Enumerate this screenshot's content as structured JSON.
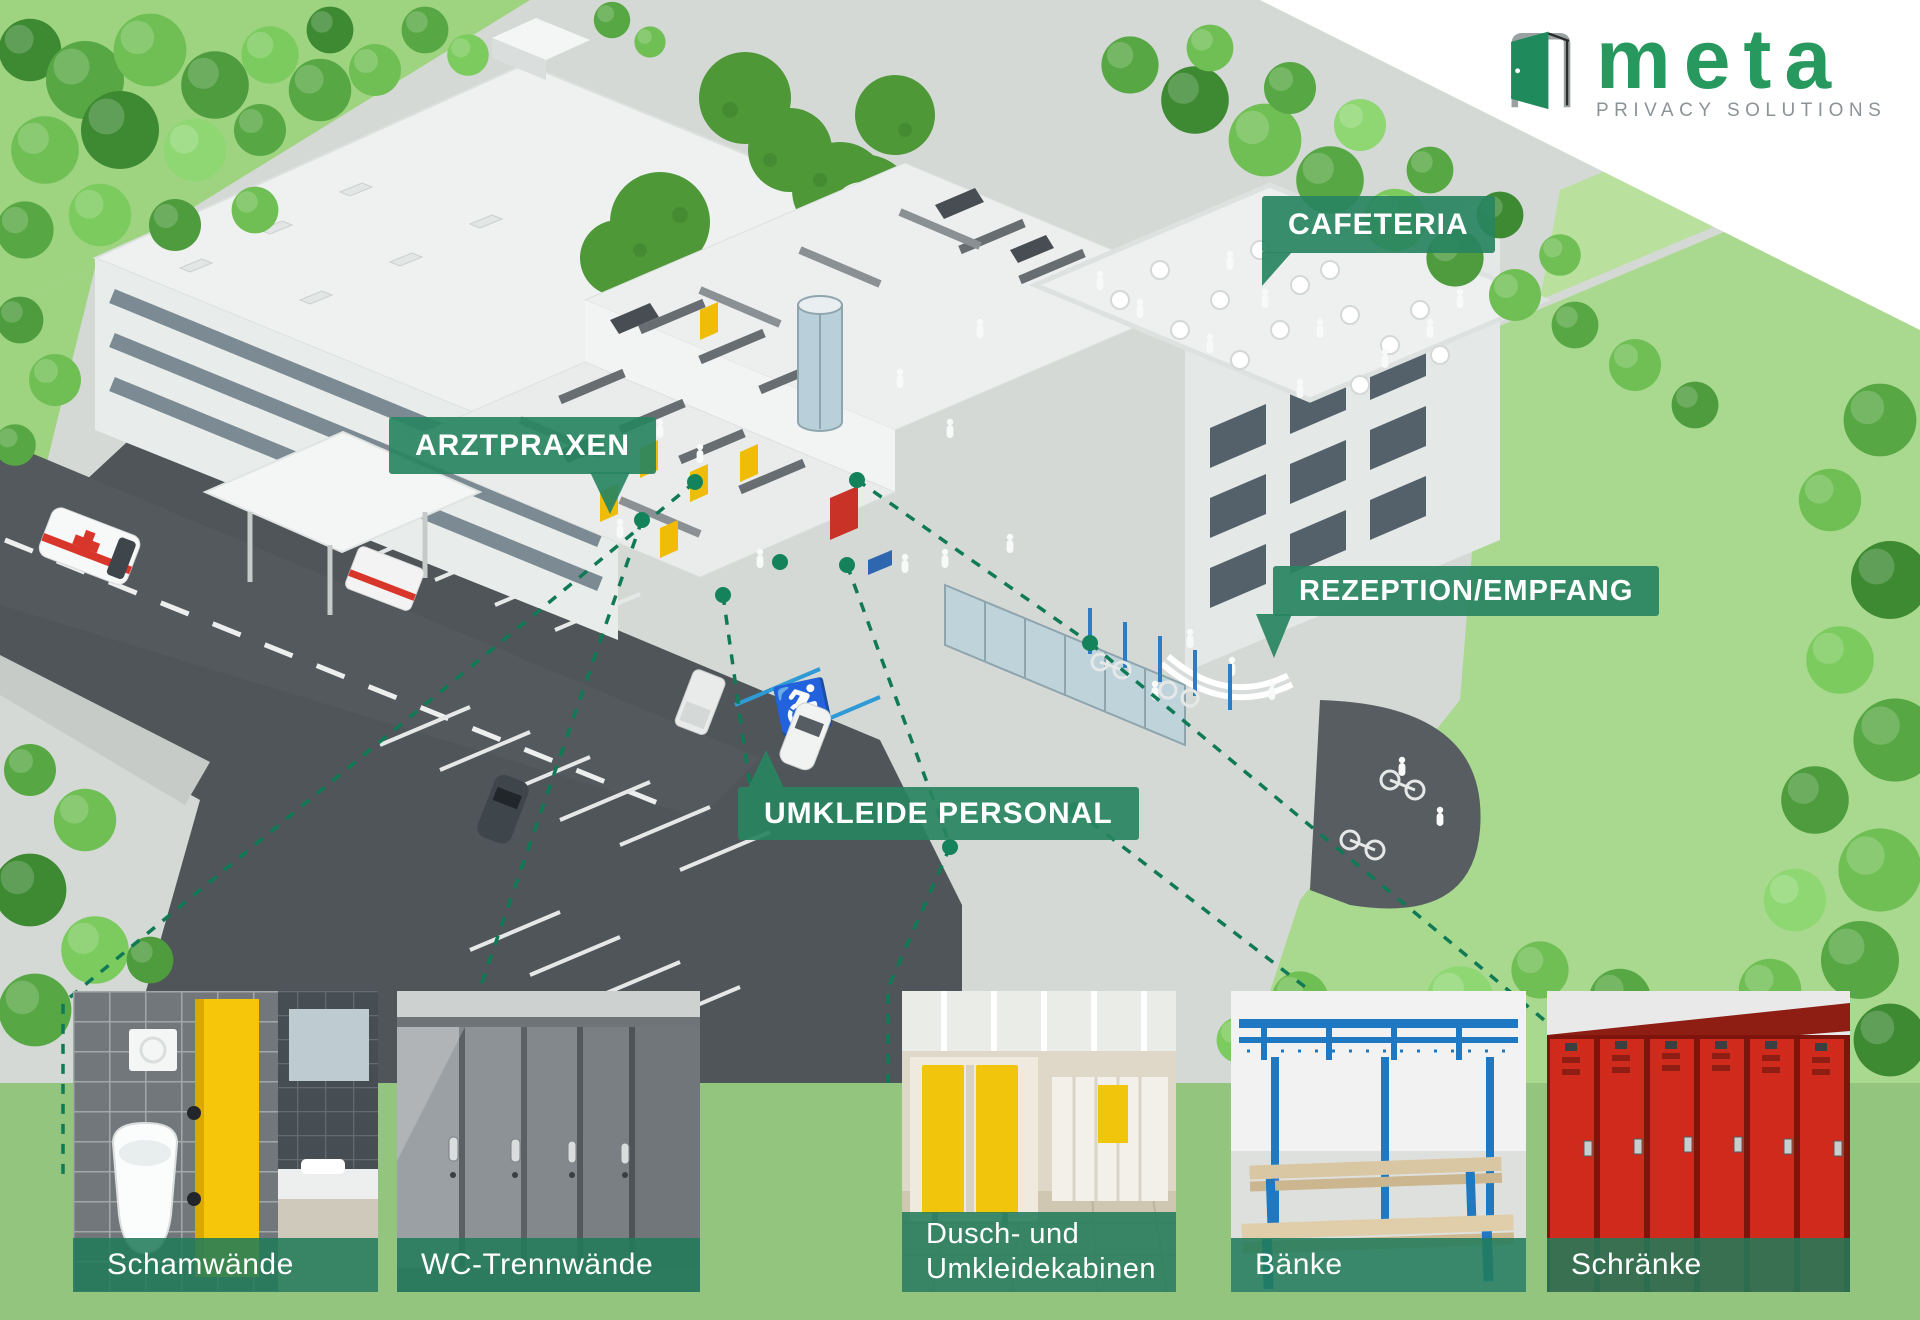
{
  "logo": {
    "brand": "meta",
    "tagline": "PRIVACY SOLUTIONS"
  },
  "area_labels": {
    "cafeteria": "CAFETERIA",
    "arztpraxen": "ARZTPRAXEN",
    "rezeption": "REZEPTION/EMPFANG",
    "umkleide": "UMKLEIDE PERSONAL"
  },
  "products": [
    {
      "id": "schamwaende",
      "label": "Schamwände"
    },
    {
      "id": "wc-trennwaende",
      "label": "WC-Trennwände"
    },
    {
      "id": "dusch-und-umkleidekabinen",
      "label": "Dusch- und\nUmkleidekabinen"
    },
    {
      "id": "baenke",
      "label": "Bänke"
    },
    {
      "id": "schraenke",
      "label": "Schränke"
    }
  ],
  "colors": {
    "accent": "#2E8A64",
    "accent-dark": "#0F7A55",
    "label-bg": "rgba(40,132,97,0.92)",
    "caption-bg": "rgba(33,123,90,0.87)",
    "footer": "#93C57E",
    "logo-green": "#27995F",
    "logo-gray": "#8C9396",
    "roof-garden": "#4E9838",
    "asphalt": "#4F5559",
    "handicap-blue": "#2F9BD6",
    "door-yellow": "#EFBD07",
    "locker-red": "#CF2A1B",
    "bench-blue": "#1E79C2"
  }
}
